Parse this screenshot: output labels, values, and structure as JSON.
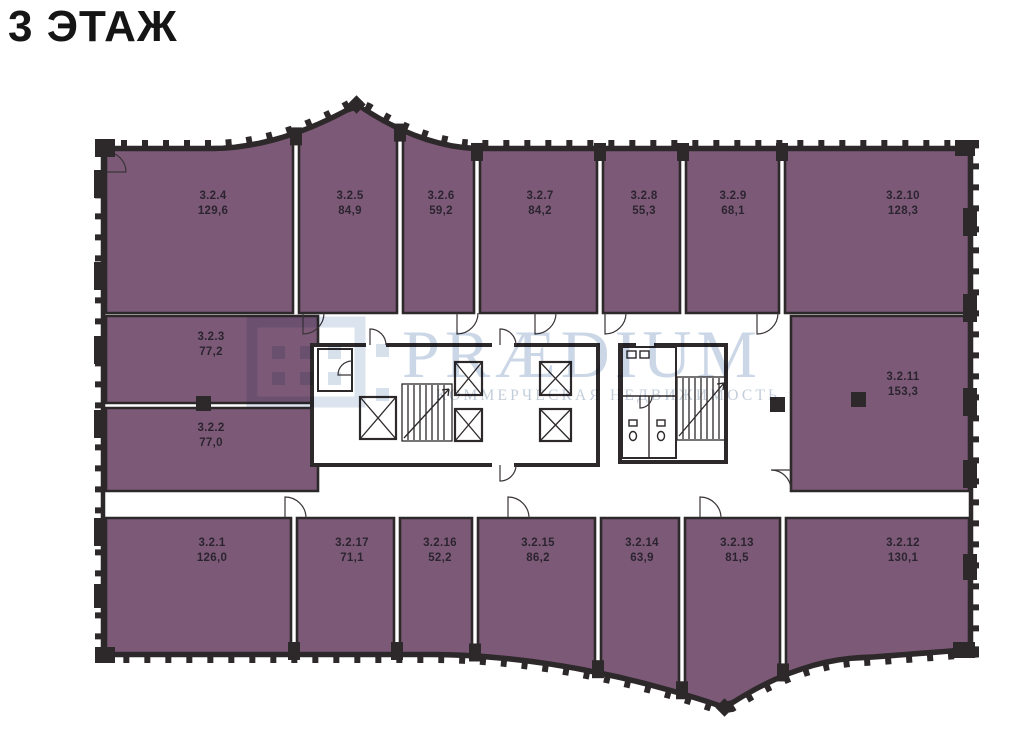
{
  "title": "3 ЭТАЖ",
  "watermark": {
    "brand": "PRÆDIUM",
    "tagline": "КОММЕРЧЕСКАЯ НЕДВИЖИМОСТЬ"
  },
  "colors": {
    "room_fill": "#7c5a77",
    "wall": "#2d282a",
    "label": "#2b2430",
    "watermark_blue": "#b7c8dd",
    "background": "#ffffff",
    "title_color": "#151515"
  },
  "floor_plan": {
    "units": [
      {
        "id": "3.2.4",
        "area": "129,6",
        "row": "top",
        "x1": 106,
        "x2": 293,
        "lx": 213,
        "ly": 199
      },
      {
        "id": "3.2.5",
        "area": "84,9",
        "row": "top",
        "x1": 299,
        "x2": 397,
        "lx": 350,
        "ly": 199
      },
      {
        "id": "3.2.6",
        "area": "59,2",
        "row": "top",
        "x1": 403,
        "x2": 474,
        "lx": 441,
        "ly": 199
      },
      {
        "id": "3.2.7",
        "area": "84,2",
        "row": "top",
        "x1": 480,
        "x2": 597,
        "lx": 540,
        "ly": 199
      },
      {
        "id": "3.2.8",
        "area": "55,3",
        "row": "top",
        "x1": 603,
        "x2": 680,
        "lx": 644,
        "ly": 199
      },
      {
        "id": "3.2.9",
        "area": "68,1",
        "row": "top",
        "x1": 686,
        "x2": 779,
        "lx": 733,
        "ly": 199
      },
      {
        "id": "3.2.10",
        "area": "128,3",
        "row": "top",
        "x1": 785,
        "x2": 969,
        "lx": 903,
        "ly": 199
      },
      {
        "id": "3.2.3",
        "area": "77,2",
        "row": "mid",
        "x1": 106,
        "x2": 318,
        "y1": 316,
        "y2": 403,
        "lx": 211,
        "ly": 340
      },
      {
        "id": "3.2.2",
        "area": "77,0",
        "row": "mid",
        "x1": 106,
        "x2": 318,
        "y1": 408,
        "y2": 491,
        "lx": 211,
        "ly": 431
      },
      {
        "id": "3.2.11",
        "area": "153,3",
        "row": "mid",
        "x1": 791,
        "x2": 969,
        "y1": 316,
        "y2": 491,
        "lx": 903,
        "ly": 380
      },
      {
        "id": "3.2.1",
        "area": "126,0",
        "row": "bottom",
        "x1": 106,
        "x2": 291,
        "lx": 212,
        "ly": 546
      },
      {
        "id": "3.2.17",
        "area": "71,1",
        "row": "bottom",
        "x1": 297,
        "x2": 394,
        "lx": 352,
        "ly": 546
      },
      {
        "id": "3.2.16",
        "area": "52,2",
        "row": "bottom",
        "x1": 400,
        "x2": 472,
        "lx": 440,
        "ly": 546
      },
      {
        "id": "3.2.15",
        "area": "86,2",
        "row": "bottom",
        "x1": 478,
        "x2": 595,
        "lx": 538,
        "ly": 546
      },
      {
        "id": "3.2.14",
        "area": "63,9",
        "row": "bottom",
        "x1": 601,
        "x2": 679,
        "lx": 642,
        "ly": 546
      },
      {
        "id": "3.2.13",
        "area": "81,5",
        "row": "bottom",
        "x1": 685,
        "x2": 780,
        "lx": 737,
        "ly": 546
      },
      {
        "id": "3.2.12",
        "area": "130,1",
        "row": "bottom",
        "x1": 786,
        "x2": 969,
        "lx": 903,
        "ly": 546
      }
    ]
  }
}
